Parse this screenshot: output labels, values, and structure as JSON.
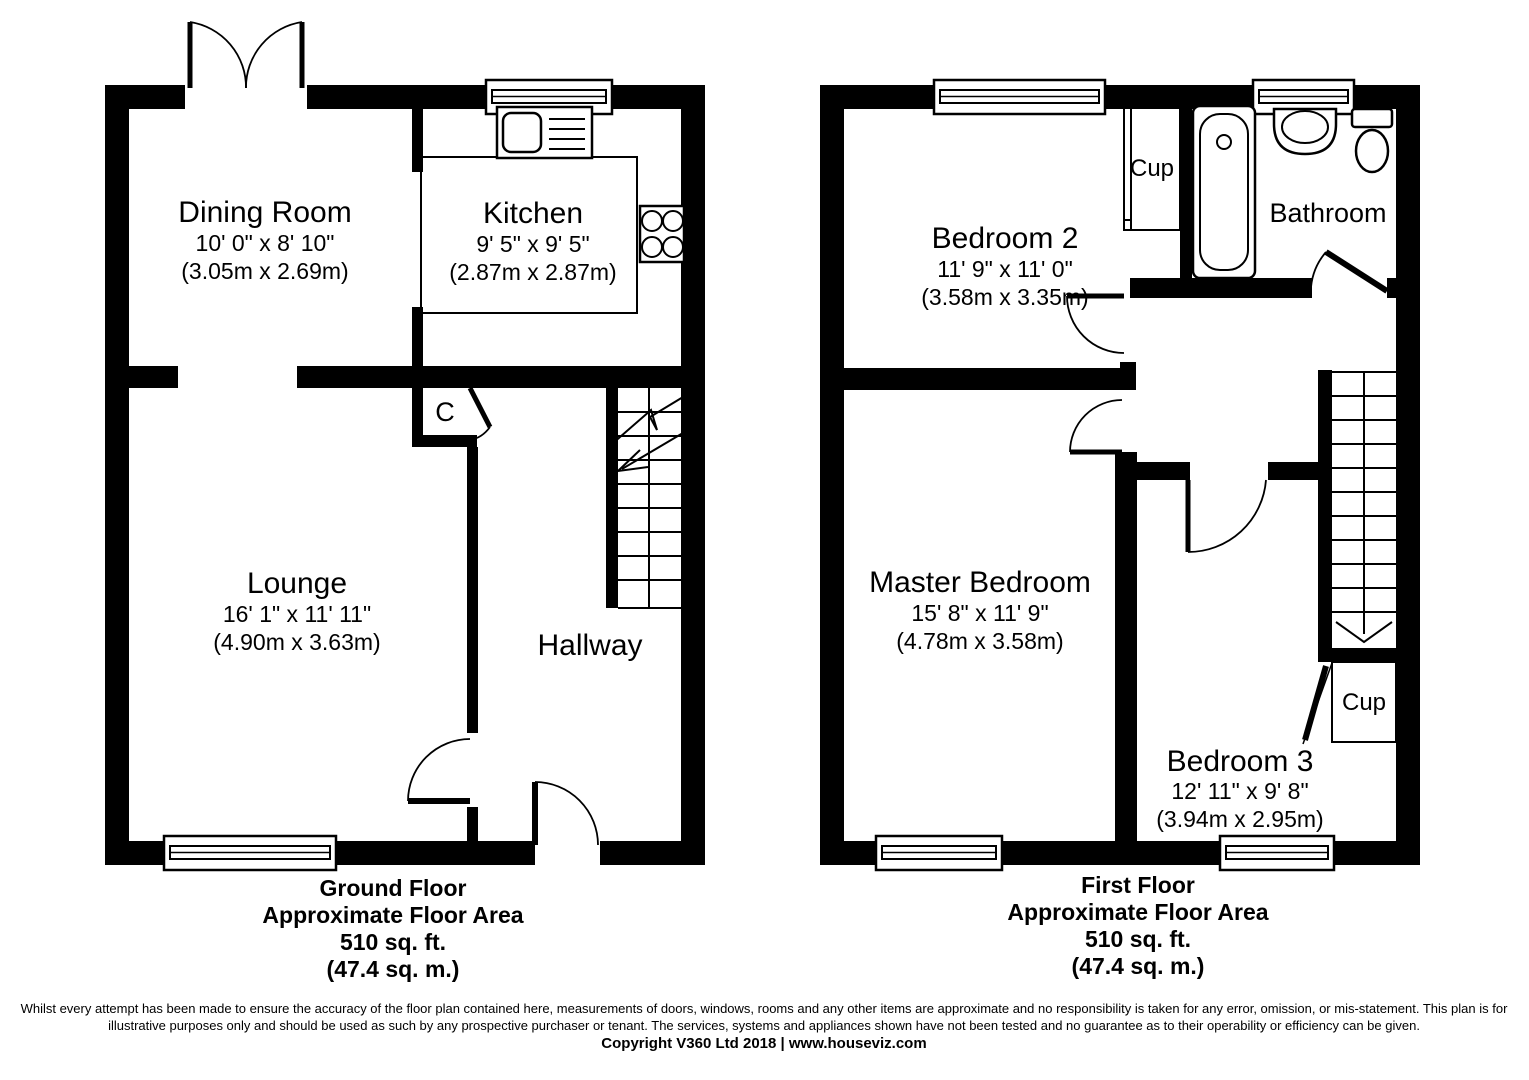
{
  "ground_floor": {
    "rooms": {
      "dining_room": {
        "name": "Dining Room",
        "size_imperial": "10' 0\" x 8' 10\"",
        "size_metric": "(3.05m x 2.69m)"
      },
      "kitchen": {
        "name": "Kitchen",
        "size_imperial": "9' 5\" x 9' 5\"",
        "size_metric": "(2.87m x 2.87m)"
      },
      "lounge": {
        "name": "Lounge",
        "size_imperial": "16' 1\" x 11' 11\"",
        "size_metric": "(4.90m x 3.63m)"
      },
      "hallway": {
        "name": "Hallway"
      },
      "cupboard": {
        "name": "C"
      }
    },
    "caption": {
      "title": "Ground Floor",
      "subtitle": "Approximate Floor Area",
      "area_imperial": "510 sq. ft.",
      "area_metric": "(47.4 sq. m.)"
    }
  },
  "first_floor": {
    "rooms": {
      "bedroom2": {
        "name": "Bedroom 2",
        "size_imperial": "11' 9\" x 11' 0\"",
        "size_metric": "(3.58m x 3.35m)"
      },
      "bathroom": {
        "name": "Bathroom"
      },
      "cupboard_top": {
        "name": "Cup"
      },
      "master_bedroom": {
        "name": "Master Bedroom",
        "size_imperial": "15' 8\" x 11' 9\"",
        "size_metric": "(4.78m x 3.58m)"
      },
      "bedroom3": {
        "name": "Bedroom 3",
        "size_imperial": "12' 11\" x 9' 8\"",
        "size_metric": "(3.94m x 2.95m)"
      },
      "cupboard_bottom": {
        "name": "Cup"
      }
    },
    "caption": {
      "title": "First Floor",
      "subtitle": "Approximate Floor Area",
      "area_imperial": "510 sq. ft.",
      "area_metric": "(47.4 sq. m.)"
    }
  },
  "footer": {
    "disclaimer_line1": "Whilst every attempt has been made to ensure the accuracy of the floor plan contained here, measurements of doors, windows, rooms and any other items are approximate and no responsibility is taken for any error, omission, or mis-statement. This plan is for",
    "disclaimer_line2": "illustrative purposes only and should be used as such by any prospective purchaser or tenant. The services, systems and appliances shown have not been tested and no guarantee as to their operability or efficiency can be given.",
    "copyright": "Copyright V360 Ltd 2018 | www.houseviz.com"
  }
}
